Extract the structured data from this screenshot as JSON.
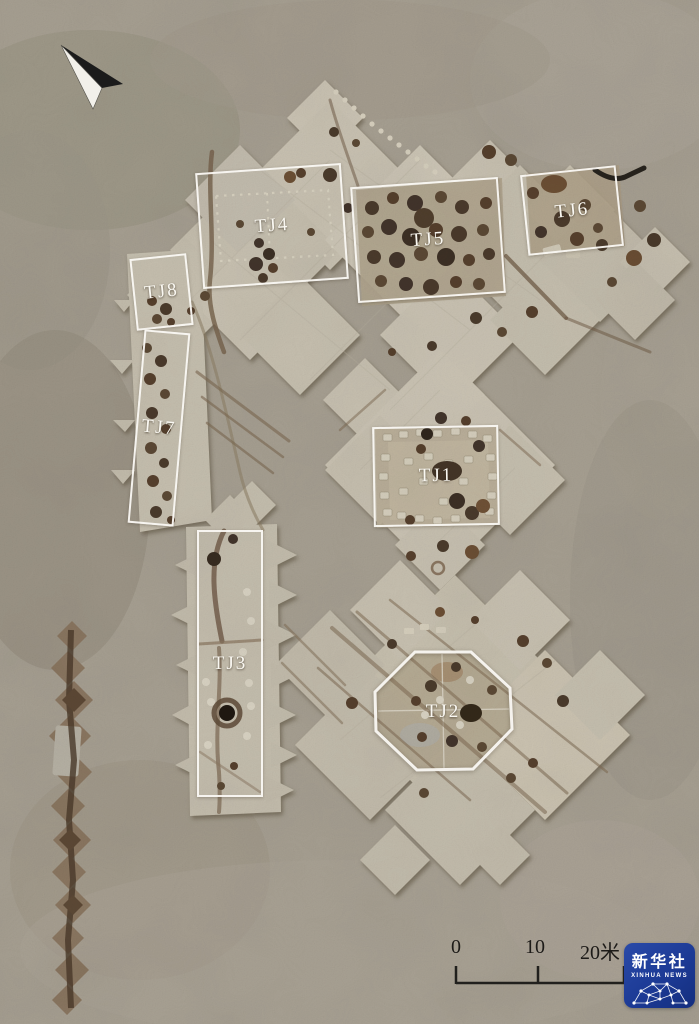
{
  "annotations": {
    "tj1": "TJ1",
    "tj2": "TJ2",
    "tj3": "TJ3",
    "tj4": "TJ4",
    "tj5": "TJ5",
    "tj6": "TJ6",
    "tj7": "TJ7",
    "tj8": "TJ8"
  },
  "scale_bar": {
    "tick_labels": [
      "0",
      "10",
      "20米"
    ]
  },
  "logo": {
    "name_cn": "新华社",
    "name_en": "XINHUA NEWS",
    "color": "#1c3a95"
  },
  "icons": {
    "north_arrow": "north-arrow-icon",
    "logo_globe": "globe-network-icon"
  },
  "colors": {
    "ground": "#a69f91",
    "excavated": "#c9c2b2",
    "annotation_white": "#f8f6f0",
    "pit_dark": "#46372a",
    "trench_brown": "#6b5640"
  }
}
